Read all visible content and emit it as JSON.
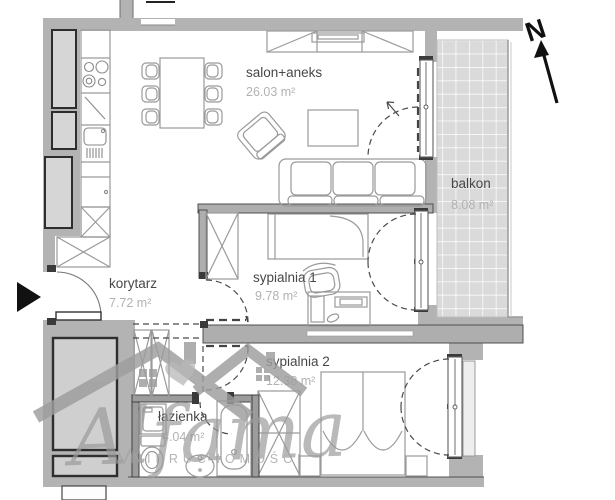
{
  "rooms": {
    "salon": {
      "name": "salon+aneks",
      "area": "26.03 m²"
    },
    "balkon": {
      "name": "balkon",
      "area": "8.08 m²"
    },
    "korytarz": {
      "name": "korytarz",
      "area": "7.72 m²"
    },
    "sypialnia1": {
      "name": "sypialnia 1",
      "area": "9.78 m²"
    },
    "sypialnia2": {
      "name": "sypialnia 2",
      "area": "12.38 m²"
    },
    "lazienka": {
      "name": "łazienka",
      "area": "4.04 m²"
    }
  },
  "compass": {
    "north_label": "N"
  },
  "watermark": {
    "brand": "Alfama",
    "subtitle": "NIERUCHOMOŚCI"
  },
  "colors": {
    "wall_gray": "#b3b3b3",
    "balcony_tile": "#dadada",
    "room_name_text": "#474747",
    "area_text": "#b2b2b2",
    "watermark_gray": "#9b9b9b",
    "accent_black": "#111111"
  }
}
